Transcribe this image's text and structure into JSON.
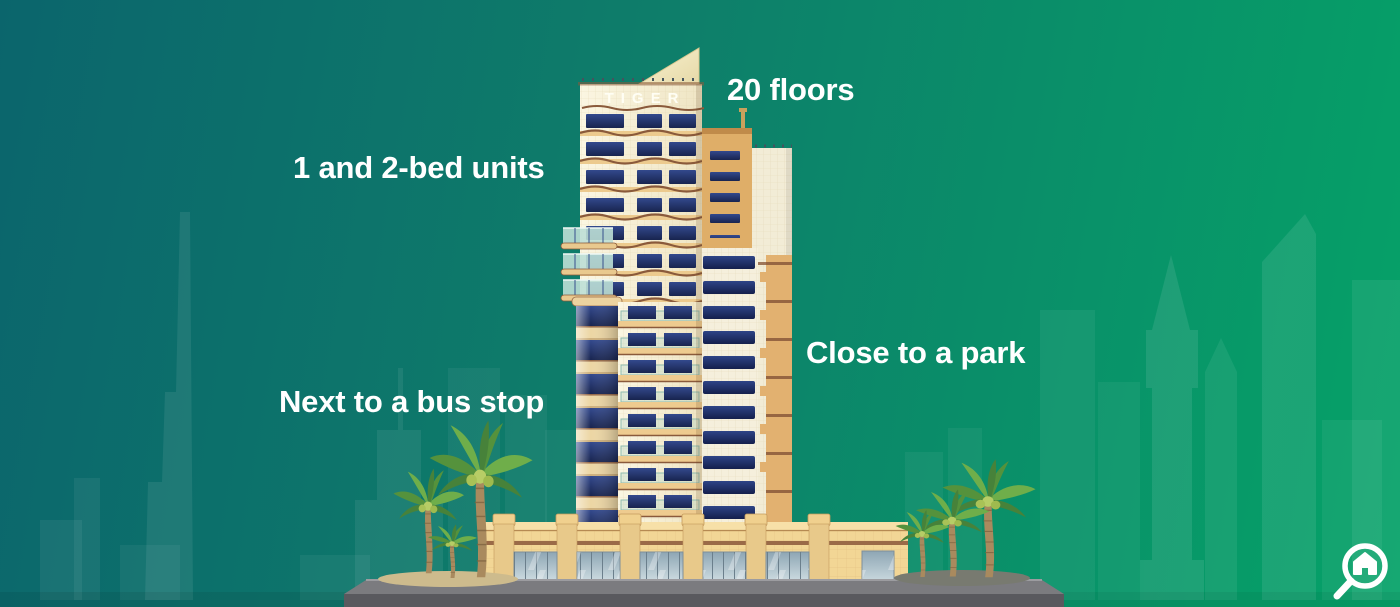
{
  "infographic": {
    "building_sign": "TIGER",
    "annotations": {
      "floors": "20 floors",
      "units": "1 and 2-bed units",
      "park": "Close to a park",
      "bus_stop": "Next to a bus stop"
    },
    "logo": {
      "icon": "magnifier-house-icon",
      "color": "#ffffff"
    },
    "colors": {
      "background_teal": "#0b656c",
      "background_green": "#05a268",
      "annotation_text": "#ffffff",
      "tower_cream": "#f6efd6",
      "window_navy": "#1f2f66",
      "floor_band_tan": "#e9c88c",
      "band_brown": "#8a5a3b",
      "back_tower_tan": "#dfae68",
      "podium_tan": "#f2d695",
      "road_gray": "#77777b",
      "palm_green": "#5e9a3f"
    }
  }
}
